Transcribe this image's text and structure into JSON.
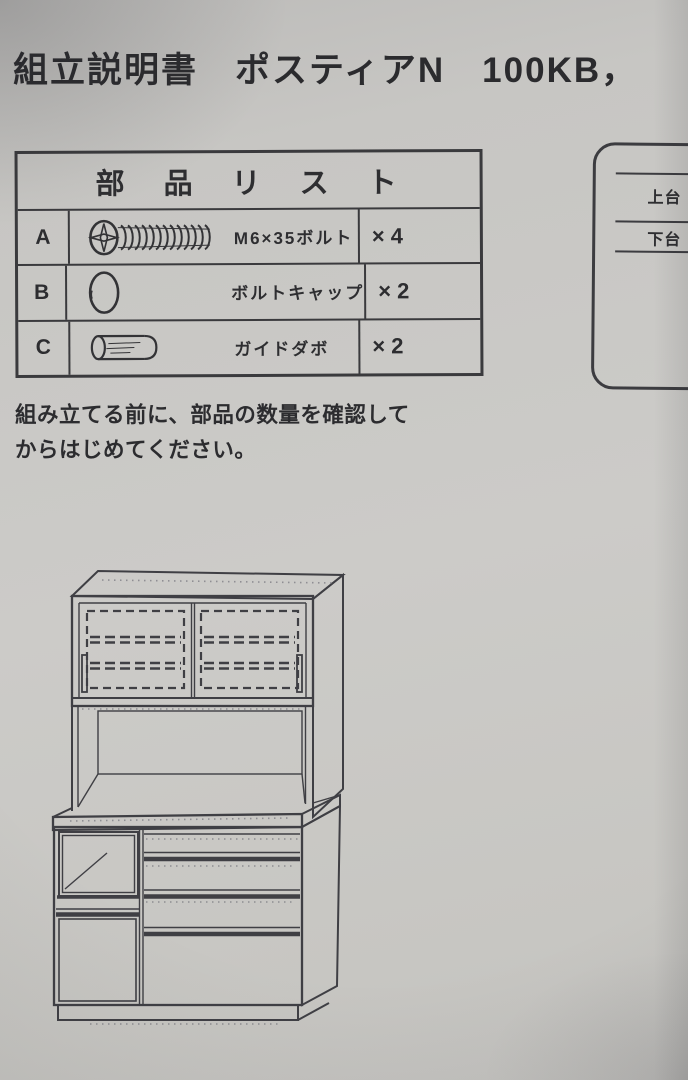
{
  "colors": {
    "paper": "#c8c7c3",
    "ink": "#2d2d30",
    "line": "#3f3f44"
  },
  "document": {
    "title": "組立説明書　ポスティアN　100KB，"
  },
  "parts_list": {
    "header": "部　品　リ　ス　ト",
    "rows": [
      {
        "id": "A",
        "icon": "m6-bolt-icon",
        "name": "M6×35ボルト",
        "qty": "×4"
      },
      {
        "id": "B",
        "icon": "bolt-cap-icon",
        "name": "ボルトキャップ",
        "qty": "×2"
      },
      {
        "id": "C",
        "icon": "guide-dowel-icon",
        "name": "ガイドダボ",
        "qty": "×2"
      }
    ]
  },
  "note": {
    "lines": [
      "組み立てる前に、部品の数量を確認して",
      "からはじめてください。"
    ]
  },
  "side_diagram": {
    "upper_label": "上台",
    "lower_label": "下台"
  },
  "figure": {
    "name": "cabinet-assembly-line-drawing"
  }
}
